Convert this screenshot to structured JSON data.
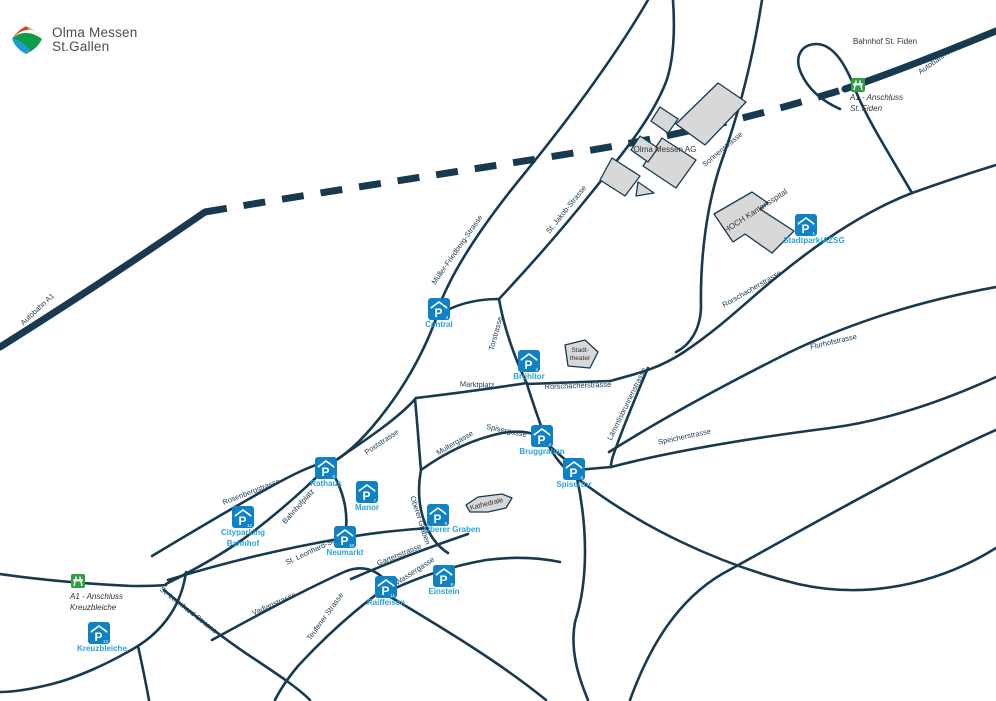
{
  "logo": {
    "line1": "Olma Messen",
    "line2": "St.Gallen"
  },
  "colors": {
    "road": "#173a50",
    "parking_blue": "#0f82c5",
    "parking_label_blue": "#2ba2db",
    "motorway_green": "#2f9e47",
    "building_gray": "#d8d8d8",
    "dark_text": "#333333"
  },
  "map": {
    "street_labels": [
      {
        "text": "Autobahn A1",
        "x": 938,
        "y": 62,
        "rot": -35
      },
      {
        "text": "Autobahn A1",
        "x": 39,
        "y": 311,
        "rot": -43
      },
      {
        "text": "Sonnenstrasse",
        "x": 724,
        "y": 151,
        "rot": -40
      },
      {
        "text": "St. Jakob-Strasse",
        "x": 568,
        "y": 211,
        "rot": -51
      },
      {
        "text": "Müller-Friedberg-Strasse",
        "x": 459,
        "y": 251,
        "rot": -55
      },
      {
        "text": "Torstrasse",
        "x": 498,
        "y": 334,
        "rot": -75
      },
      {
        "text": "Marktplatz",
        "x": 477,
        "y": 387,
        "rot": 2
      },
      {
        "text": "Rorschacherstrasse",
        "x": 578,
        "y": 388,
        "rot": -2
      },
      {
        "text": "Rorschacherstrasse",
        "x": 753,
        "y": 291,
        "rot": -30
      },
      {
        "text": "Flurhofstrasse",
        "x": 834,
        "y": 344,
        "rot": -13
      },
      {
        "text": "Lämmlisbrunnenstrasse",
        "x": 629,
        "y": 405,
        "rot": -64
      },
      {
        "text": "Speicherstrasse",
        "x": 685,
        "y": 439,
        "rot": -12
      },
      {
        "text": "Spisergasse",
        "x": 506,
        "y": 433,
        "rot": 12
      },
      {
        "text": "Multergasse",
        "x": 456,
        "y": 445,
        "rot": -30
      },
      {
        "text": "Rosenbergstrasse",
        "x": 252,
        "y": 494,
        "rot": -21
      },
      {
        "text": "Bahnhofplatz",
        "x": 300,
        "y": 508,
        "rot": -48
      },
      {
        "text": "Poststrasse",
        "x": 383,
        "y": 444,
        "rot": -34
      },
      {
        "text": "St. Leonhard-Strasse",
        "x": 319,
        "y": 550,
        "rot": -25
      },
      {
        "text": "St. Leonhard-Strasse",
        "x": 187,
        "y": 612,
        "rot": 38
      },
      {
        "text": "Vadianstrasse",
        "x": 275,
        "y": 606,
        "rot": -24
      },
      {
        "text": "Teufener Strasse",
        "x": 327,
        "y": 618,
        "rot": -54
      },
      {
        "text": "Gartenstrasse",
        "x": 400,
        "y": 557,
        "rot": -22
      },
      {
        "text": "Wassergasse",
        "x": 416,
        "y": 573,
        "rot": -33
      },
      {
        "text": "Oberer Graben",
        "x": 418,
        "y": 521,
        "rot": 72
      }
    ],
    "place_labels": [
      {
        "text": "Bahnhof St. Fiden",
        "x": 885,
        "y": 44,
        "rot": 0,
        "size": 8
      },
      {
        "text": "Olma Messen AG",
        "x": 665,
        "y": 152,
        "rot": 0,
        "size": 8
      },
      {
        "text": "HOCH Kantonsspital",
        "x": 757,
        "y": 213,
        "rot": -33,
        "size": 8
      },
      {
        "text": "Stadt-",
        "x": 580,
        "y": 352,
        "rot": 0,
        "size": 6.5
      },
      {
        "text": "theater",
        "x": 580,
        "y": 360,
        "rot": 0,
        "size": 6.5
      },
      {
        "text": "Kathedrale",
        "x": 487,
        "y": 506,
        "rot": -14,
        "size": 7
      }
    ],
    "parkings": [
      {
        "name": "Stadtpark/AZSG",
        "number": "1",
        "x": 806,
        "y": 225,
        "label_lines": [
          "Stadtpark/AZSG"
        ],
        "label_x": 814,
        "label_y": 243
      },
      {
        "name": "Brühltor",
        "number": "2",
        "x": 529,
        "y": 361,
        "label_lines": [
          "Brühltor"
        ],
        "label_x": 529,
        "label_y": 379
      },
      {
        "name": "Central",
        "number": "3",
        "x": 439,
        "y": 309,
        "label_lines": [
          "Central"
        ],
        "label_x": 439,
        "label_y": 327
      },
      {
        "name": "Bruggraben",
        "number": "4",
        "x": 542,
        "y": 436,
        "label_lines": [
          "Bruggraben"
        ],
        "label_x": 542,
        "label_y": 454
      },
      {
        "name": "Spisertor",
        "number": "5",
        "x": 574,
        "y": 469,
        "label_lines": [
          "Spisertor"
        ],
        "label_x": 574,
        "label_y": 487
      },
      {
        "name": "Rathaus",
        "number": "6",
        "x": 326,
        "y": 468,
        "label_lines": [
          "Rathaus"
        ],
        "label_x": 326,
        "label_y": 486
      },
      {
        "name": "Manor",
        "number": "7",
        "x": 367,
        "y": 492,
        "label_lines": [
          "Manor"
        ],
        "label_x": 367,
        "label_y": 510
      },
      {
        "name": "Oberer Graben",
        "number": "8",
        "x": 438,
        "y": 515,
        "label_lines": [
          "Oberer Graben"
        ],
        "label_x": 452,
        "label_y": 532
      },
      {
        "name": "Einstein",
        "number": "9",
        "x": 444,
        "y": 576,
        "label_lines": [
          "Einstein"
        ],
        "label_x": 444,
        "label_y": 594
      },
      {
        "name": "Neumarkt",
        "number": "10",
        "x": 345,
        "y": 537,
        "label_lines": [
          "Neumarkt"
        ],
        "label_x": 345,
        "label_y": 555
      },
      {
        "name": "Raiffeisen",
        "number": "11",
        "x": 386,
        "y": 587,
        "label_lines": [
          "Raiffeisen"
        ],
        "label_x": 386,
        "label_y": 605
      },
      {
        "name": "Cityparking Bahnhof",
        "number": "12",
        "x": 243,
        "y": 517,
        "label_lines": [
          "Cityparking",
          "Bahnhof"
        ],
        "label_x": 243,
        "label_y": 535
      },
      {
        "name": "Kreuzbleiche",
        "number": "13",
        "x": 99,
        "y": 633,
        "label_lines": [
          "Kreuzbleiche"
        ],
        "label_x": 102,
        "label_y": 651
      }
    ],
    "motorway_exits": [
      {
        "x": 858,
        "y": 85,
        "lines": [
          "A1 - Anschluss",
          "St. Fiden"
        ],
        "label_x": 850,
        "label_y": 100
      },
      {
        "x": 78,
        "y": 581,
        "lines": [
          "A1 - Anschluss",
          "Kreuzbleiche"
        ],
        "label_x": 70,
        "label_y": 599
      }
    ]
  }
}
